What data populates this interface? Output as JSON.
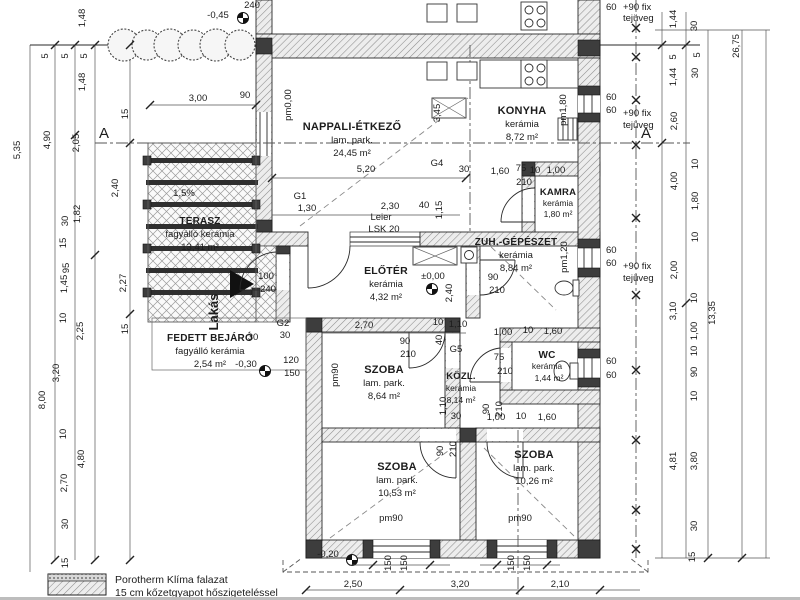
{
  "rooms": {
    "nappali": {
      "name": "NAPPALI-ÉTKEZŐ",
      "finish": "lam. park.",
      "area": "24,45 m²"
    },
    "konyha": {
      "name": "KONYHA",
      "finish": "kerámia",
      "area": "8,72 m²"
    },
    "kamra": {
      "name": "KAMRA",
      "finish": "kerámia",
      "area": "1,80 m²"
    },
    "zuh": {
      "name": "ZUH.-GÉPÉSZET",
      "finish": "kerámia",
      "area": "8,84 m²"
    },
    "wc": {
      "name": "WC",
      "finish": "kerámia",
      "area": "1,44 m²"
    },
    "eloter": {
      "name": "ELŐTÉR",
      "finish": "kerámia",
      "area": "4,32 m²"
    },
    "kozl": {
      "name": "KÖZL.",
      "finish": "kerámia",
      "area": "8,14 m²"
    },
    "szoba1": {
      "name": "SZOBA",
      "finish": "lam. park.",
      "area": "8,64 m²"
    },
    "szoba2": {
      "name": "SZOBA",
      "finish": "lam. park.",
      "area": "10,53 m²"
    },
    "szoba3": {
      "name": "SZOBA",
      "finish": "lam. park.",
      "area": "10,26 m²"
    },
    "terasz": {
      "name": "TERASZ",
      "finish": "fagyálló kerámia",
      "area": "13,41 m²"
    },
    "fedett": {
      "name": "FEDETT BEJÁRÓ",
      "finish": "fagyálló kerámia",
      "area": "2,54 m²"
    }
  },
  "section": {
    "label": "A"
  },
  "legend": {
    "line1": "Porotherm Klíma falazat",
    "line2": "15 cm kőzetgyapot hőszigeteléssel"
  },
  "fix": {
    "a": "+90 fix",
    "b": "tejüveg"
  },
  "dims": {
    "left": [
      "1,48",
      "5",
      "5",
      "5",
      "1,48",
      "5,35",
      "4,90",
      "2,05",
      "15",
      "2,40",
      "1,82",
      "30",
      "15",
      "95",
      "1,45",
      "2,27",
      "10",
      "2,25",
      "15",
      "3,20",
      "8,00",
      "10",
      "4,80",
      "2,70",
      "30",
      "15"
    ],
    "right": [
      "1,44",
      "30",
      "5",
      "5",
      "26,75",
      "1,44",
      "30",
      "2,60",
      "10",
      "4,00",
      "1,80",
      "10",
      "2,00",
      "3,10",
      "10",
      "1,00",
      "10",
      "13,35",
      "90",
      "10",
      "4,81",
      "3,80",
      "30",
      "15"
    ],
    "sixty": [
      "60",
      "60",
      "60",
      "60",
      "60",
      "60",
      "60"
    ],
    "bottom": [
      "2,50",
      "3,20",
      "2,10"
    ],
    "win150": [
      "150",
      "150",
      "150",
      "150"
    ]
  },
  "ann": {
    "top240": "240",
    "lvl_top": "-0,45",
    "d300": "3,00",
    "top90": "90",
    "pm000": "pm0,00",
    "d345": "3,45",
    "d520": "5,20",
    "g4": "G4",
    "n30a": "30",
    "g1": "G1",
    "d130": "1,30",
    "d230": "2,30",
    "n40": "40",
    "d115": "1,15",
    "leier1": "Leier",
    "leier2": "LSK 20",
    "kamra_row": [
      "1,60",
      "75",
      "10",
      "1,00"
    ],
    "kamra210": "210",
    "zuh_door": [
      "90",
      "210"
    ],
    "sill_konyha": "pm1,80",
    "sill_zuh": "pm1,20",
    "entry_door": [
      "100",
      "240"
    ],
    "lvl_eloter": "±0,00",
    "d240": "2,40",
    "g2": "G2",
    "g2_30": "30",
    "row270": [
      "2,70",
      "10",
      "1,10"
    ],
    "szoba1_door": [
      "90",
      "210"
    ],
    "g5": "G5",
    "g5_40": "40",
    "d110": "1,10",
    "n30b": "30",
    "wc_row_top": [
      "1,00",
      "10",
      "1,60"
    ],
    "wc_door": [
      "75",
      "210"
    ],
    "szoba3_door": [
      "90",
      "210"
    ],
    "wc_row_bot": [
      "1,00",
      "10",
      "1,60"
    ],
    "szoba2_door": [
      "90",
      "210"
    ],
    "entry_dims": [
      "120",
      "150"
    ],
    "lvl_entry": "-0,30",
    "n30c": "30",
    "sill1": "pm90",
    "sill2": "pm90",
    "sill3": "pm90",
    "slope": "1,5%",
    "lakas": "Lakás",
    "lvl_bottom": "-0,20"
  }
}
